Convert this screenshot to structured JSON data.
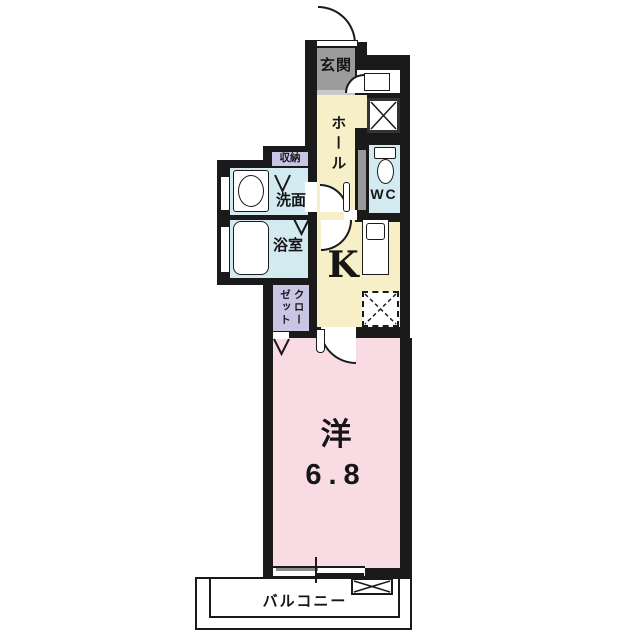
{
  "plan": {
    "type": "japanese-apartment-floorplan",
    "rooms": {
      "genkan": {
        "label": "玄関"
      },
      "hall": {
        "label": "ホール"
      },
      "wc": {
        "label": "WC"
      },
      "storage": {
        "label": "収納"
      },
      "washroom": {
        "label": "洗面"
      },
      "bathroom": {
        "label": "浴室"
      },
      "kitchen": {
        "label": "K"
      },
      "closet": {
        "label": "クローゼット"
      },
      "main_room": {
        "label": "洋",
        "size": "6.8"
      },
      "balcony": {
        "label": "バルコニー"
      }
    },
    "colors": {
      "wall": "#1a1a1a",
      "genkan_floor": "#9c9c9c",
      "genkan_step": "#c9c9c9",
      "hall_kitchen_floor": "#f6efc8",
      "wet_area_floor": "#d3eaf0",
      "storage_fill": "#c9c5e5",
      "main_room_floor": "#f9dbe4",
      "balcony_floor": "#ffffff",
      "door_panel": "#999999"
    }
  }
}
